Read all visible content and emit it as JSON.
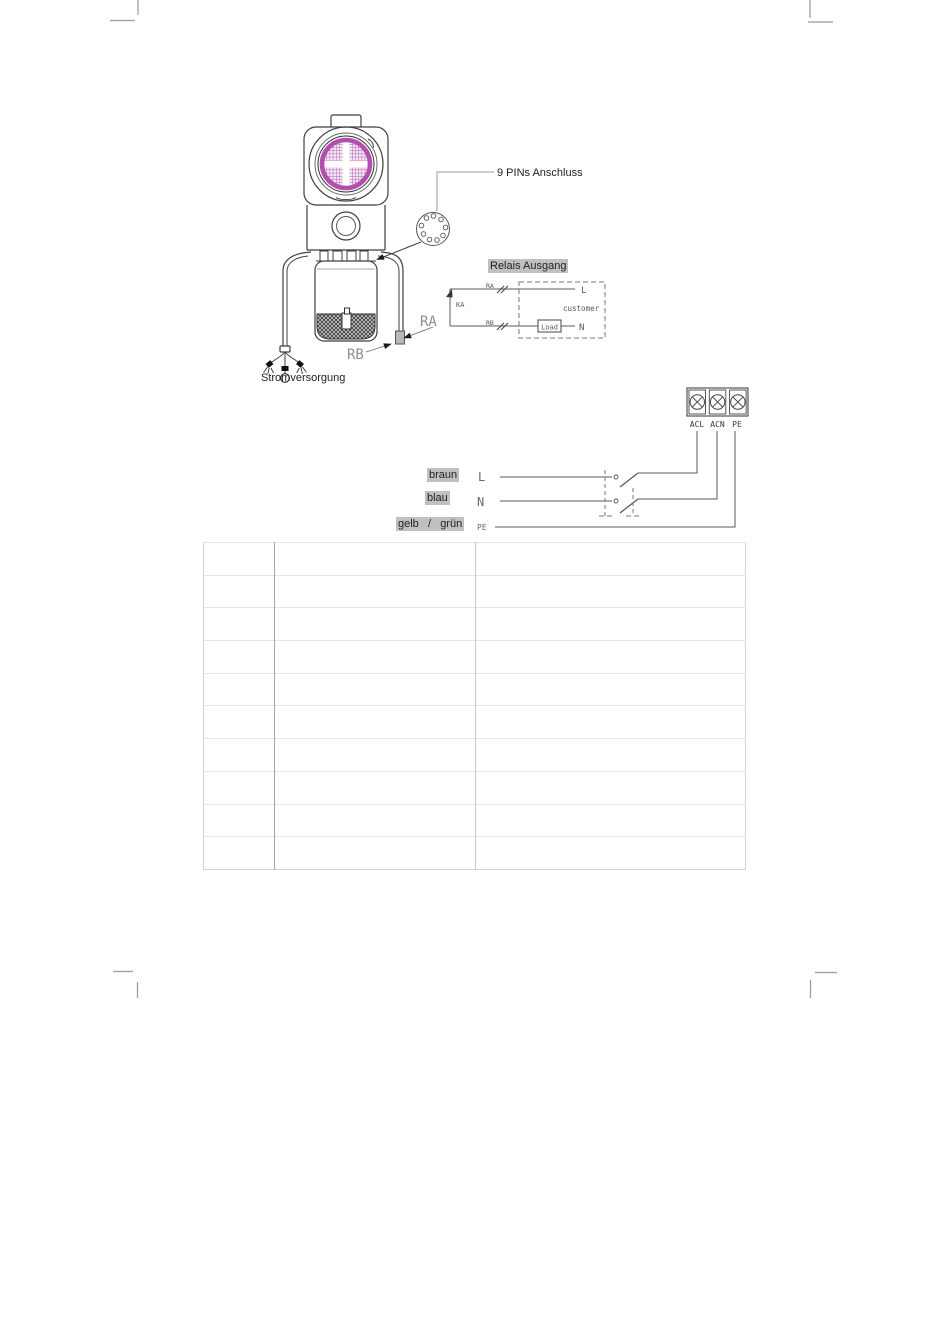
{
  "page": {
    "type": "technical-manual-wiring-page"
  },
  "colors": {
    "highlight": "#c0c0c0",
    "lens_purple": "#b24fae",
    "line_dark": "#3f3f3f"
  },
  "device": {
    "connector_callout": "9 PINs Anschluss",
    "power_callout": "Stromversorgung",
    "wire_a": "RA",
    "wire_b": "RB"
  },
  "relay": {
    "title": "Relais Ausgang",
    "contact": "KA",
    "wire_a": "RA",
    "wire_b": "RB",
    "line": "L",
    "neutral": "N",
    "load": "Load",
    "customer": "customer"
  },
  "terminal_block": {
    "terminals": [
      "ACL",
      "ACN",
      "PE"
    ]
  },
  "mains": {
    "brown": "braun",
    "blue": "blau",
    "yellow_green": "gelb   /   grün",
    "line": "L",
    "neutral": "N",
    "pe": "PE"
  },
  "table": {
    "rows": 10,
    "columns": 3
  }
}
